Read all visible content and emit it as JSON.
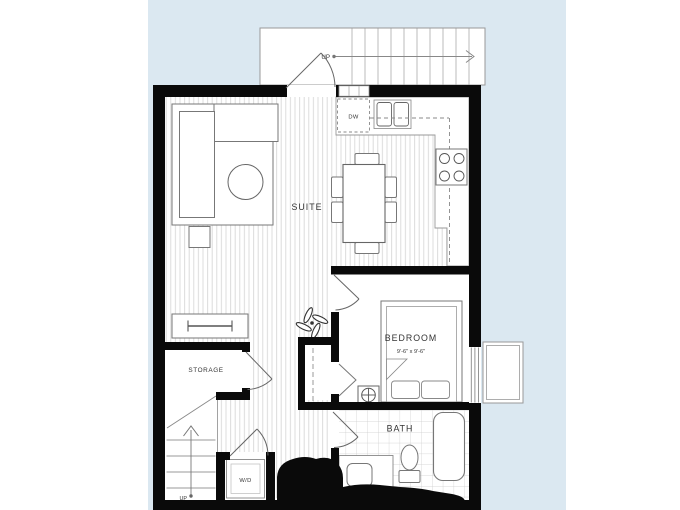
{
  "title": "One-bedroom suite floor plan",
  "labels": {
    "suite": "SUITE",
    "bedroom": "BEDROOM",
    "bedroom_dims": "9'-6\" x 9'-6\"",
    "bath": "BATH",
    "storage": "STORAGE",
    "washer_dryer": "W/D",
    "dishwasher": "DW",
    "stairs_up_upper": "UP",
    "stairs_up_lower": "UP"
  },
  "rooms": [
    {
      "name": "SUITE"
    },
    {
      "name": "BEDROOM",
      "dimensions": "9'-6\" x 9'-6\""
    },
    {
      "name": "BATH"
    },
    {
      "name": "STORAGE"
    },
    {
      "name": "W/D"
    }
  ],
  "colors": {
    "page_background": "#ffffff",
    "panel_blue": "#dbe8f1",
    "wall_black": "#0a0a0a",
    "thin_line": "#999999",
    "furniture_line": "#777777",
    "floor_stripe": "#d8d8d8",
    "tile_line": "#cccccc",
    "label_text": "#333333"
  }
}
